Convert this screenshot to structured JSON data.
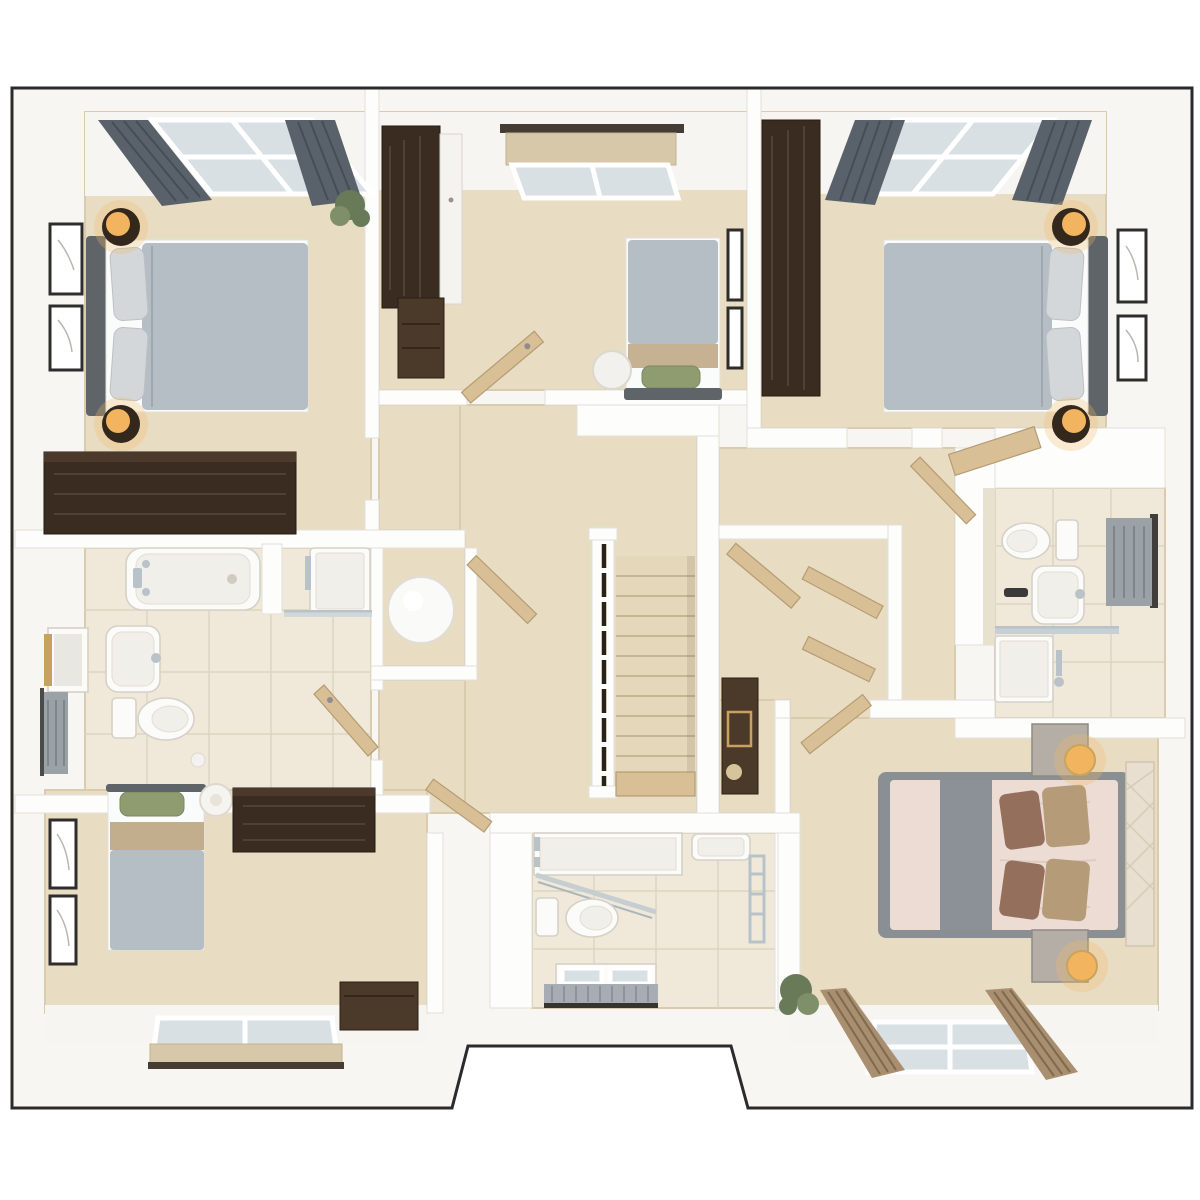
{
  "meta": {
    "kind": "3d-floor-plan-render",
    "floor": "upper-floor",
    "visible_text": "none"
  },
  "palette": {
    "outline": "#2b2b2b",
    "plate": "#f7f6f3",
    "wall": "#fdfdfc",
    "wall_edge": "#e3e0da",
    "soffit": "#f6f5f1",
    "carpet": "#e8dcc3",
    "carpet_shadow": "#d9cbae",
    "tile": "#f0e9da",
    "tile_line": "#ddd4c0",
    "wood_dark": "#3a2c20",
    "wood_dark2": "#4b3929",
    "wood_mid": "#d8bf95",
    "wood_mid_edge": "#b59c73",
    "duvet_gray": "#b5bec5",
    "pillow_gray": "#d3d7da",
    "headboard_gray": "#5f6468",
    "curtain_slate": "#59626b",
    "blind_beige": "#d6c8a9",
    "pelmet_dark": "#453d34",
    "lamp_amber": "#f2b45f",
    "lamp_base": "#33281b",
    "green_pillow": "#8e9c70",
    "blush": "#ecdcd3",
    "runner_gray": "#8b9197",
    "pillow_brown": "#946f5c",
    "pillow_tan": "#b69b79",
    "headboard_cream": "#e8dfd0",
    "plant_green": "#687a58",
    "chrome": "#b9c2c8",
    "glass": "#d9e0e4",
    "radiator_gray": "#9aa1a7",
    "frame_dark": "#2e2d2b"
  },
  "rooms": [
    {
      "id": "bedroom-1",
      "position": "top-left",
      "type": "double-bedroom",
      "furniture": [
        "double-bed-gray",
        "headboard",
        "two-pillows",
        "bedside-lamp-x2",
        "wall-art-x2",
        "dark-wood-dresser",
        "window-with-gray-curtains",
        "plant"
      ]
    },
    {
      "id": "bedroom-3",
      "position": "top-middle",
      "type": "single-bedroom",
      "furniture": [
        "single-bed-gray",
        "green-cushion",
        "dark-wood-wardrobe",
        "drawer-unit",
        "wall-art-x2",
        "window-with-roman-blind",
        "round-pouf",
        "open-door"
      ]
    },
    {
      "id": "bedroom-2",
      "position": "top-right",
      "type": "double-bedroom",
      "furniture": [
        "double-bed-gray",
        "headboard",
        "two-pillows",
        "bedside-lamp-x2",
        "wall-art-x2",
        "dark-wood-wardrobe-strip",
        "window-with-gray-curtains",
        "angled-bench",
        "open-door"
      ]
    },
    {
      "id": "family-bathroom",
      "position": "middle-left",
      "type": "bathroom",
      "furniture": [
        "bathtub",
        "shower-enclosure",
        "washbasin",
        "mirror-cabinet",
        "toilet",
        "towel-rail",
        "tiled-floor",
        "open-door"
      ]
    },
    {
      "id": "airing-cupboard",
      "position": "center-left",
      "type": "storage",
      "furniture": [
        "decor-sphere",
        "open-door"
      ]
    },
    {
      "id": "landing",
      "position": "center",
      "type": "hallway",
      "furniture": [
        "staircase-down",
        "banister-with-dark-spindles",
        "console-table",
        "gold-frame-decor"
      ]
    },
    {
      "id": "dressing-area",
      "position": "center-right",
      "type": "hallway",
      "furniture": [
        "open-wardrobe-doors-x3"
      ]
    },
    {
      "id": "en-suite-bathroom",
      "position": "right",
      "type": "bathroom",
      "furniture": [
        "toilet",
        "washbasin",
        "towel-rail",
        "shower-with-glass-screen",
        "tiled-floor"
      ]
    },
    {
      "id": "bedroom-4",
      "position": "bottom-right",
      "type": "double-bedroom",
      "furniture": [
        "double-bed-blush",
        "gray-runner",
        "brown-pillows-x4",
        "cream-quilted-headboard",
        "nightstand-x2",
        "globe-lamp-x2",
        "window-with-brown-curtains",
        "plant",
        "open-door"
      ]
    },
    {
      "id": "shower-room",
      "position": "bottom-middle",
      "type": "bathroom",
      "furniture": [
        "shower-tray-with-glass-screen",
        "toilet",
        "washbasin",
        "towel-rail",
        "radiator",
        "low-window",
        "tiled-floor"
      ]
    },
    {
      "id": "bedroom-5",
      "position": "bottom-left",
      "type": "single-bedroom",
      "furniture": [
        "single-bed-gray",
        "green-cushion",
        "pendant-light",
        "wall-art-x2",
        "dark-wood-desk",
        "dark-wood-chest",
        "window-with-roman-blind",
        "open-door"
      ]
    }
  ]
}
